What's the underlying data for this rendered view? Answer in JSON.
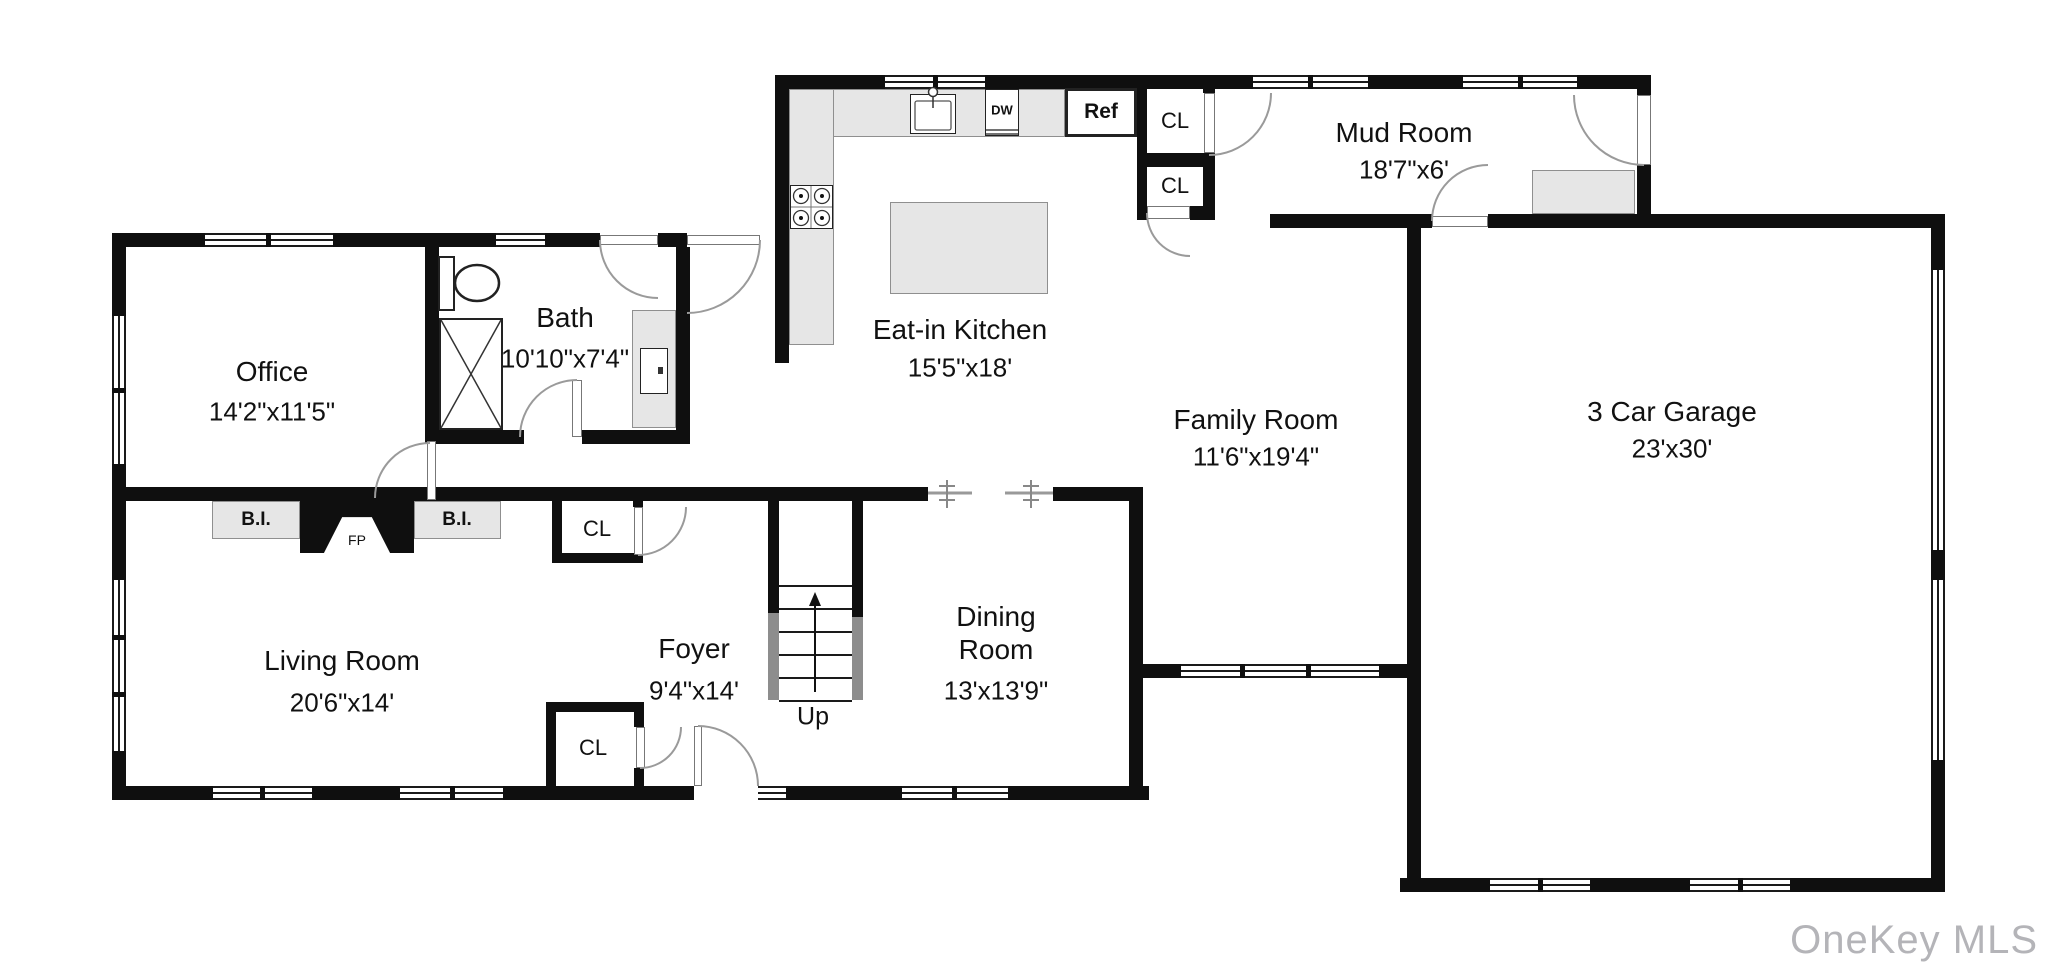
{
  "watermark": "OneKey MLS",
  "rooms": [
    {
      "id": "office",
      "name": "Office",
      "dims": "14'2\"x11'5\""
    },
    {
      "id": "bath",
      "name": "Bath",
      "dims": "10'10\"x7'4\""
    },
    {
      "id": "kitchen",
      "name": "Eat-in Kitchen",
      "dims": "15'5\"x18'"
    },
    {
      "id": "mudroom",
      "name": "Mud Room",
      "dims": "18'7\"x6'"
    },
    {
      "id": "family",
      "name": "Family Room",
      "dims": "11'6\"x19'4\""
    },
    {
      "id": "garage",
      "name": "3 Car Garage",
      "dims": "23'x30'"
    },
    {
      "id": "living",
      "name": "Living Room",
      "dims": "20'6\"x14'"
    },
    {
      "id": "foyer",
      "name": "Foyer",
      "dims": "9'4\"x14'"
    },
    {
      "id": "dining",
      "name": "Dining",
      "name2": "Room",
      "dims": "13'x13'9\""
    }
  ],
  "labels": {
    "up": "Up",
    "fp": "FP",
    "bi": "B.I.",
    "cl": "CL",
    "dw": "DW",
    "ref": "Ref"
  },
  "colors": {
    "wall": "#0f0f0f",
    "counter": "#e6e6e6",
    "watermark": "#b4b4b8"
  }
}
